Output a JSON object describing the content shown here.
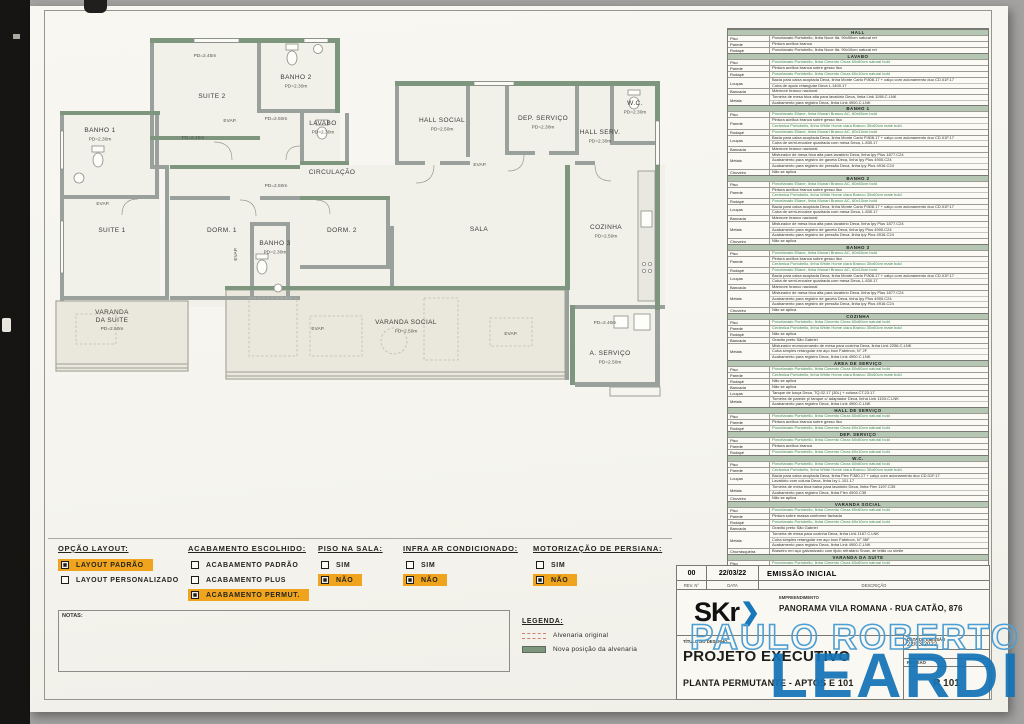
{
  "colors": {
    "accent_orange": "#f0a41e",
    "watermark_blue": "#1474b6",
    "wall_green": "#7e967e",
    "table_header_green": "#b5c7b2",
    "spec_green_text": "#3d8a55"
  },
  "plan": {
    "rooms": [
      {
        "name": "SUITE 2",
        "x": 158,
        "y": 72
      },
      {
        "name": "BANHO 2",
        "pd": "PD=2.30m",
        "x": 242,
        "y": 53
      },
      {
        "name": "BANHO 1",
        "pd": "PD=2.30m",
        "x": 46,
        "y": 106
      },
      {
        "name": "LAVABO",
        "pd": "PD=2.30m",
        "x": 269,
        "y": 99
      },
      {
        "name": "HALL SOCIAL",
        "pd": "PD=2.50m",
        "x": 388,
        "y": 96
      },
      {
        "name": "DEP. SERVIÇO",
        "pd": "PD=2.30m",
        "x": 489,
        "y": 94
      },
      {
        "name": "HALL SERV.",
        "pd": "PD=2.30m",
        "x": 546,
        "y": 108
      },
      {
        "name": "W.C.",
        "pd": "PD=2.30m",
        "x": 581,
        "y": 79
      },
      {
        "name": "CIRCULAÇÃO",
        "x": 278,
        "y": 148
      },
      {
        "name": "SUITE 1",
        "x": 58,
        "y": 206
      },
      {
        "name": "DORM. 1",
        "x": 168,
        "y": 206
      },
      {
        "name": "DORM. 2",
        "x": 288,
        "y": 206
      },
      {
        "name": "BANHO 3",
        "pd": "PD=2.30m",
        "x": 221,
        "y": 219
      },
      {
        "name": "SALA",
        "x": 425,
        "y": 205
      },
      {
        "name": "COZINHA",
        "pd": "PD=2.50m",
        "x": 552,
        "y": 203
      },
      {
        "name": "VARANDA DA SUITE",
        "lines": [
          "VARANDA",
          "DA SUITE"
        ],
        "pd": "PD=2.50m",
        "x": 58,
        "y": 288
      },
      {
        "name": "VARANDA SOCIAL",
        "pd": "PD=2.50m",
        "x": 352,
        "y": 298
      },
      {
        "name": "A. SERVIÇO",
        "pd": "PD=2.50m",
        "x": 556,
        "y": 329
      }
    ],
    "small_labels": [
      {
        "t": "PD=2.45m",
        "x": 151,
        "y": 31
      },
      {
        "t": "PD=2.50m",
        "x": 222,
        "y": 94
      },
      {
        "t": "PD=2.45m",
        "x": 139,
        "y": 113
      },
      {
        "t": "PD=2.50m",
        "x": 222,
        "y": 161
      },
      {
        "t": "PD=2.40m",
        "x": 551,
        "y": 298
      },
      {
        "t": "EVAP.",
        "x": 176,
        "y": 96
      },
      {
        "t": "EVAP.",
        "x": 426,
        "y": 140
      },
      {
        "t": "EVAP.",
        "x": 49,
        "y": 179
      },
      {
        "t": "EVAP.",
        "x": 457,
        "y": 309
      },
      {
        "t": "EVAP.",
        "x": 264,
        "y": 304
      },
      {
        "t": "EVAP.",
        "x": 183,
        "y": 228,
        "rot": -90
      }
    ]
  },
  "spec_table": {
    "sections": [
      {
        "title": "HALL",
        "rows": [
          {
            "label": "Piso",
            "lines": [
              "Porcelanato Portobello, linha Noce Itá. 90x90cm natural ret"
            ]
          },
          {
            "label": "Parede",
            "lines": [
              "Pintura acrílica branca"
            ]
          },
          {
            "label": "Rodapé",
            "lines": [
              "Porcelanato Portobello, linha Noce Itá. 90x10cm natural ret"
            ]
          }
        ]
      },
      {
        "title": "LAVABO",
        "rows": [
          {
            "label": "Piso",
            "lines": [
              "g:Porcelanato Portobello, linha Cimento Cinza 60x60cm natural bold"
            ]
          },
          {
            "label": "Parede",
            "lines": [
              "Pintura acrílica branca sobre gesso liso"
            ]
          },
          {
            "label": "Rodapé",
            "lines": [
              "g:Porcelanato Portobello, linha Cimento Cinza 60x10cm natural bold"
            ]
          },
          {
            "label": "Louças",
            "lines": [
              "Bacia para caixa acoplada Deca, linha Monte Carlo P.808.17 + calço com acionamento duo CD.01F.17",
              "Cuba de apoio retangular Deca L.1400.17"
            ]
          },
          {
            "label": "Bancada",
            "lines": [
              "Mármore branco nacional"
            ]
          },
          {
            "label": "Metais",
            "lines": [
              "Torneira de mesa bica alta para lavatório Deca, linha Link 1198.C.LNK",
              "Acabamento para registro Deca, linha Link 4900.C.LNK"
            ]
          }
        ]
      },
      {
        "title": "BANHO 1",
        "rows": [
          {
            "label": "Piso",
            "lines": [
              "g:Porcelanato Eliane, linha Munari Branco AC, 60x60cm bold"
            ]
          },
          {
            "label": "Parede",
            "lines": [
              "Pintura acrílica branca sobre gesso liso",
              "g:Cerâmica Portobello, linha White Home clara Branco 30x60cm mate bold"
            ]
          },
          {
            "label": "Rodapé",
            "lines": [
              "g:Porcelanato Eliane, linha Munari Branco AC, 60x10cm bold"
            ]
          },
          {
            "label": "Louças",
            "lines": [
              "Bacia para caixa acoplada Deca, linha Monte Carlo P.808.17 + calço com acionamento duo CD.01F.17",
              "Cuba de semi-encaixe quadrada com mesa Deca, L.830.17"
            ]
          },
          {
            "label": "Bancada",
            "lines": [
              "Mármore branco nacional"
            ]
          },
          {
            "label": "Metais",
            "lines": [
              "Misturador de mesa bica alta para lavatório Deca, linha Ipy Plus 1877.C24",
              "Acabamento para registro de gaveta Deca, linha Ipy Plus 4900.C24",
              "Acabamento para registro de pressão Deca, linha Ipy Plus 4916.C24"
            ]
          },
          {
            "label": "Chuveiro",
            "lines": [
              "Não se aplica"
            ]
          }
        ]
      },
      {
        "title": "BANHO 2",
        "rows": [
          {
            "label": "Piso",
            "lines": [
              "g:Porcelanato Eliane, linha Munari Branco AC, 60x60cm bold"
            ]
          },
          {
            "label": "Parede",
            "lines": [
              "Pintura acrílica branca sobre gesso liso",
              "g:Cerâmica Portobello, linha White Home clara Branco 30x60cm mate bold"
            ]
          },
          {
            "label": "Rodapé",
            "lines": [
              "g:Porcelanato Eliane, linha Munari Branco AC, 60x10cm bold"
            ]
          },
          {
            "label": "Louças",
            "lines": [
              "Bacia para caixa acoplada Deca, linha Monte Carlo P.808.17 + calço com acionamento duo CD.01F.17",
              "Cuba de semi-encaixe quadrada com mesa Deca, L.830.17"
            ]
          },
          {
            "label": "Bancada",
            "lines": [
              "Mármore branco nacional"
            ]
          },
          {
            "label": "Metais",
            "lines": [
              "Misturador de mesa bica alta para lavatório Deca, linha Ipy Plus 1877.C24",
              "Acabamento para registro de gaveta Deca, linha Ipy Plus 4900.C24",
              "Acabamento para registro de pressão Deca, linha Ipy Plus 4916.C24"
            ]
          },
          {
            "label": "Chuveiro",
            "lines": [
              "Não se aplica"
            ]
          }
        ]
      },
      {
        "title": "BANHO 3",
        "rows": [
          {
            "label": "Piso",
            "lines": [
              "g:Porcelanato Eliane, linha Munari Branco AC, 60x60cm bold"
            ]
          },
          {
            "label": "Parede",
            "lines": [
              "Pintura acrílica branca sobre gesso liso",
              "g:Cerâmica Portobello, linha White Home clara Branco 30x60cm mate bold"
            ]
          },
          {
            "label": "Rodapé",
            "lines": [
              "g:Porcelanato Eliane, linha Munari Branco AC, 60x10cm bold"
            ]
          },
          {
            "label": "Louças",
            "lines": [
              "Bacia para caixa acoplada Deca, linha Monte Carlo P.808.17 + calço com acionamento duo CD.01F.17",
              "Cuba de semi-encaixe quadrada com mesa Deca, L.830.17"
            ]
          },
          {
            "label": "Bancada",
            "lines": [
              "Mármore branco nacional"
            ]
          },
          {
            "label": "Metais",
            "lines": [
              "Misturador de mesa bica alta para lavatório Deca, linha Ipy Plus 1877.C24",
              "Acabamento para registro de gaveta Deca, linha Ipy Plus 4900.C24",
              "Acabamento para registro de pressão Deca, linha Ipy Plus 4916.C24"
            ]
          },
          {
            "label": "Chuveiro",
            "lines": [
              "Não se aplica"
            ]
          }
        ]
      },
      {
        "title": "COZINHA",
        "rows": [
          {
            "label": "Piso",
            "lines": [
              "g:Porcelanato Portobello, linha Cimento Cinza 60x60cm natural bold"
            ]
          },
          {
            "label": "Parede",
            "lines": [
              "g:Cerâmica Portobello, linha White Home clara Branco 30x60cm mate bold"
            ]
          },
          {
            "label": "Rodapé",
            "lines": [
              "Não se aplica"
            ]
          },
          {
            "label": "Bancada",
            "lines": [
              "Granito preto São Gabriel"
            ]
          },
          {
            "label": "Metais",
            "lines": [
              "Misturador monocomando de mesa para cozinha Deca, linha Link 2256.C.LNK",
              "Cuba simples retangular em aço inox Fabrinox, N° 2F",
              "Acabamento para registro Deca, linha Link 4900.C.LNK"
            ]
          }
        ]
      },
      {
        "title": "ÁREA DE SERVIÇO",
        "rows": [
          {
            "label": "Piso",
            "lines": [
              "g:Porcelanato Portobello, linha Cimento Cinza 60x60cm natural bold"
            ]
          },
          {
            "label": "Parede",
            "lines": [
              "g:Cerâmica Portobello, linha White Home clara Branco 30x60cm mate bold"
            ]
          },
          {
            "label": "Rodapé",
            "lines": [
              "Não se aplica"
            ]
          },
          {
            "label": "Bancada",
            "lines": [
              "Não se aplica"
            ]
          },
          {
            "label": "Louças",
            "lines": [
              "Tanque de louça Deca, TQ.02.17 (30L) + coluna CT.23.17"
            ]
          },
          {
            "label": "Metais",
            "lines": [
              "Torneira de parede p/ tanque c/ adaptador Deca, linha Link 1153.C.LNK",
              "Acabamento para registro Deca, linha Link 4900.C.LNK"
            ]
          }
        ]
      },
      {
        "title": "HALL DE SERVIÇO",
        "rows": [
          {
            "label": "Piso",
            "lines": [
              "g:Porcelanato Portobello, linha Cimento Cinza 60x60cm natural bold"
            ]
          },
          {
            "label": "Parede",
            "lines": [
              "Pintura acrílica branca sobre gesso liso"
            ]
          },
          {
            "label": "Rodapé",
            "lines": [
              "g:Porcelanato Portobello, linha Cimento Cinza 60x10cm natural bold"
            ]
          }
        ]
      },
      {
        "title": "DEP. SERVIÇO",
        "rows": [
          {
            "label": "Piso",
            "lines": [
              "g:Porcelanato Portobello, linha Cimento Cinza 60x60cm natural bold"
            ]
          },
          {
            "label": "Parede",
            "lines": [
              "Pintura acrílica branca"
            ]
          },
          {
            "label": "Rodapé",
            "lines": [
              "g:Porcelanato Portobello, linha Cimento Cinza 60x10cm natural bold"
            ]
          }
        ]
      },
      {
        "title": "W.C.",
        "rows": [
          {
            "label": "Piso",
            "lines": [
              "g:Porcelanato Portobello, linha Cimento Cinza 60x60cm natural bold"
            ]
          },
          {
            "label": "Parede",
            "lines": [
              "g:Cerâmica Portobello, linha White Home clara Branco 30x60cm mate bold"
            ]
          },
          {
            "label": "Louças",
            "lines": [
              "Bacia para caixa acoplada Deca, linha Flex P.380.17 + calço com acionamento duo CD.01F.17",
              "Lavatório com coluna Deca, linha Izy L.101.17"
            ]
          },
          {
            "label": "Metais",
            "lines": [
              "Torneira de mesa bica baixa para lavatório Deca, linha Flex 1197.C35",
              "Acabamento para registro Deca, linha Flex 4900.C35"
            ]
          },
          {
            "label": "Chuveiro",
            "lines": [
              "Não se aplica"
            ]
          }
        ]
      },
      {
        "title": "VARANDA SOCIAL",
        "rows": [
          {
            "label": "Piso",
            "lines": [
              "g:Porcelanato Portobello, linha Cimento Cinza 60x60cm natural bold"
            ]
          },
          {
            "label": "Parede",
            "lines": [
              "Pintura sobre massa conforme fachada"
            ]
          },
          {
            "label": "Rodapé",
            "lines": [
              "g:Porcelanato Portobello, linha Cimento Cinza 60x10cm natural bold"
            ]
          },
          {
            "label": "Bancada",
            "lines": [
              "Granito preto São Gabriel"
            ]
          },
          {
            "label": "Metais",
            "lines": [
              "Torneira de mesa para cozinha Deca, linha Link 1167.C.LNK",
              "Cuba simples retangular em aço inox Fabrinox, N° 36F",
              "Acabamento para registro Deca, linha Link 4900.C.LNK"
            ]
          },
          {
            "label": "Churrasqueira",
            "lines": [
              "Braseiro em aço galvanizado com tijolo refratário Snow, de tetão ou símile"
            ]
          }
        ]
      },
      {
        "title": "VARANDA DA SUÍTE",
        "rows": [
          {
            "label": "Piso",
            "lines": [
              "g:Porcelanato Portobello, linha Cimento Cinza 60x60cm natural bold"
            ]
          },
          {
            "label": "Parede",
            "lines": [
              "Pintura sobre massa conforme fachada"
            ]
          },
          {
            "label": "Rodapé",
            "lines": [
              "g:Porcelanato Portobello, linha Cimento Cinza 60x10cm natural bold"
            ]
          }
        ]
      },
      {
        "title": "FERRAGENS",
        "rows": [
          {
            "label": "Portas",
            "lines": [
              "Fechadura La Fonte, linha Architect 620 cromado acetinado"
            ]
          }
        ]
      }
    ]
  },
  "options": {
    "groups": [
      {
        "title": "OPÇÃO LAYOUT:",
        "items": [
          {
            "label": "LAYOUT PADRÃO",
            "checked": true,
            "highlight": true
          },
          {
            "label": "LAYOUT PERSONALIZADO",
            "checked": false,
            "highlight": false
          }
        ]
      },
      {
        "title": "ACABAMENTO ESCOLHIDO:",
        "items": [
          {
            "label": "ACABAMENTO PADRÃO",
            "checked": false,
            "highlight": false
          },
          {
            "label": "ACABAMENTO PLUS",
            "checked": false,
            "highlight": false
          },
          {
            "label": "ACABAMENTO PERMUT.",
            "checked": true,
            "highlight": true
          }
        ]
      },
      {
        "title": "PISO NA SALA:",
        "items": [
          {
            "label": "SIM",
            "checked": false,
            "highlight": false
          },
          {
            "label": "NÃO",
            "checked": true,
            "highlight": true
          }
        ]
      },
      {
        "title": "INFRA AR CONDICIONADO:",
        "items": [
          {
            "label": "SIM",
            "checked": false,
            "highlight": false
          },
          {
            "label": "NÃO",
            "checked": true,
            "highlight": true
          }
        ]
      },
      {
        "title": "MOTORIZAÇÃO DE PERSIANA:",
        "items": [
          {
            "label": "SIM",
            "checked": false,
            "highlight": false
          },
          {
            "label": "NÃO",
            "checked": true,
            "highlight": true
          }
        ]
      }
    ]
  },
  "notes": {
    "label": "NOTAS:"
  },
  "legend": {
    "title": "LEGENDA:",
    "items": [
      {
        "swatch": "dashed-red",
        "label": "Alvenaria original"
      },
      {
        "swatch": "solid-green",
        "label": "Nova posição da alvenaria"
      }
    ]
  },
  "revision": {
    "rev": "00",
    "date": "22/03/22",
    "description": "EMISSÃO INICIAL",
    "col_headers": [
      "REV. N°",
      "DATA",
      "DESCRIÇÃO"
    ]
  },
  "title_block": {
    "logo_text": "SKr",
    "logo_arrow": "❯",
    "empreendimento_label": "EMPREENDIMENTO",
    "empreendimento": "PANORAMA VILA ROMANA - RUA CATÃO, 876",
    "titulo_label": "TÍTULO DO DESENHO",
    "titulo": "PROJETO EXECUTIVO",
    "subtitulo": "PLANTA PERMUTANTE - APTOS    E 101",
    "data_emissao_label": "DATA DE EMISSÃO",
    "data_emissao": "22/03/2022",
    "revisao_label": "REVISÃO",
    "sheet": "R 101"
  },
  "watermark": {
    "line1": "PAULO ROBERTO",
    "line2": "LEARDI"
  }
}
